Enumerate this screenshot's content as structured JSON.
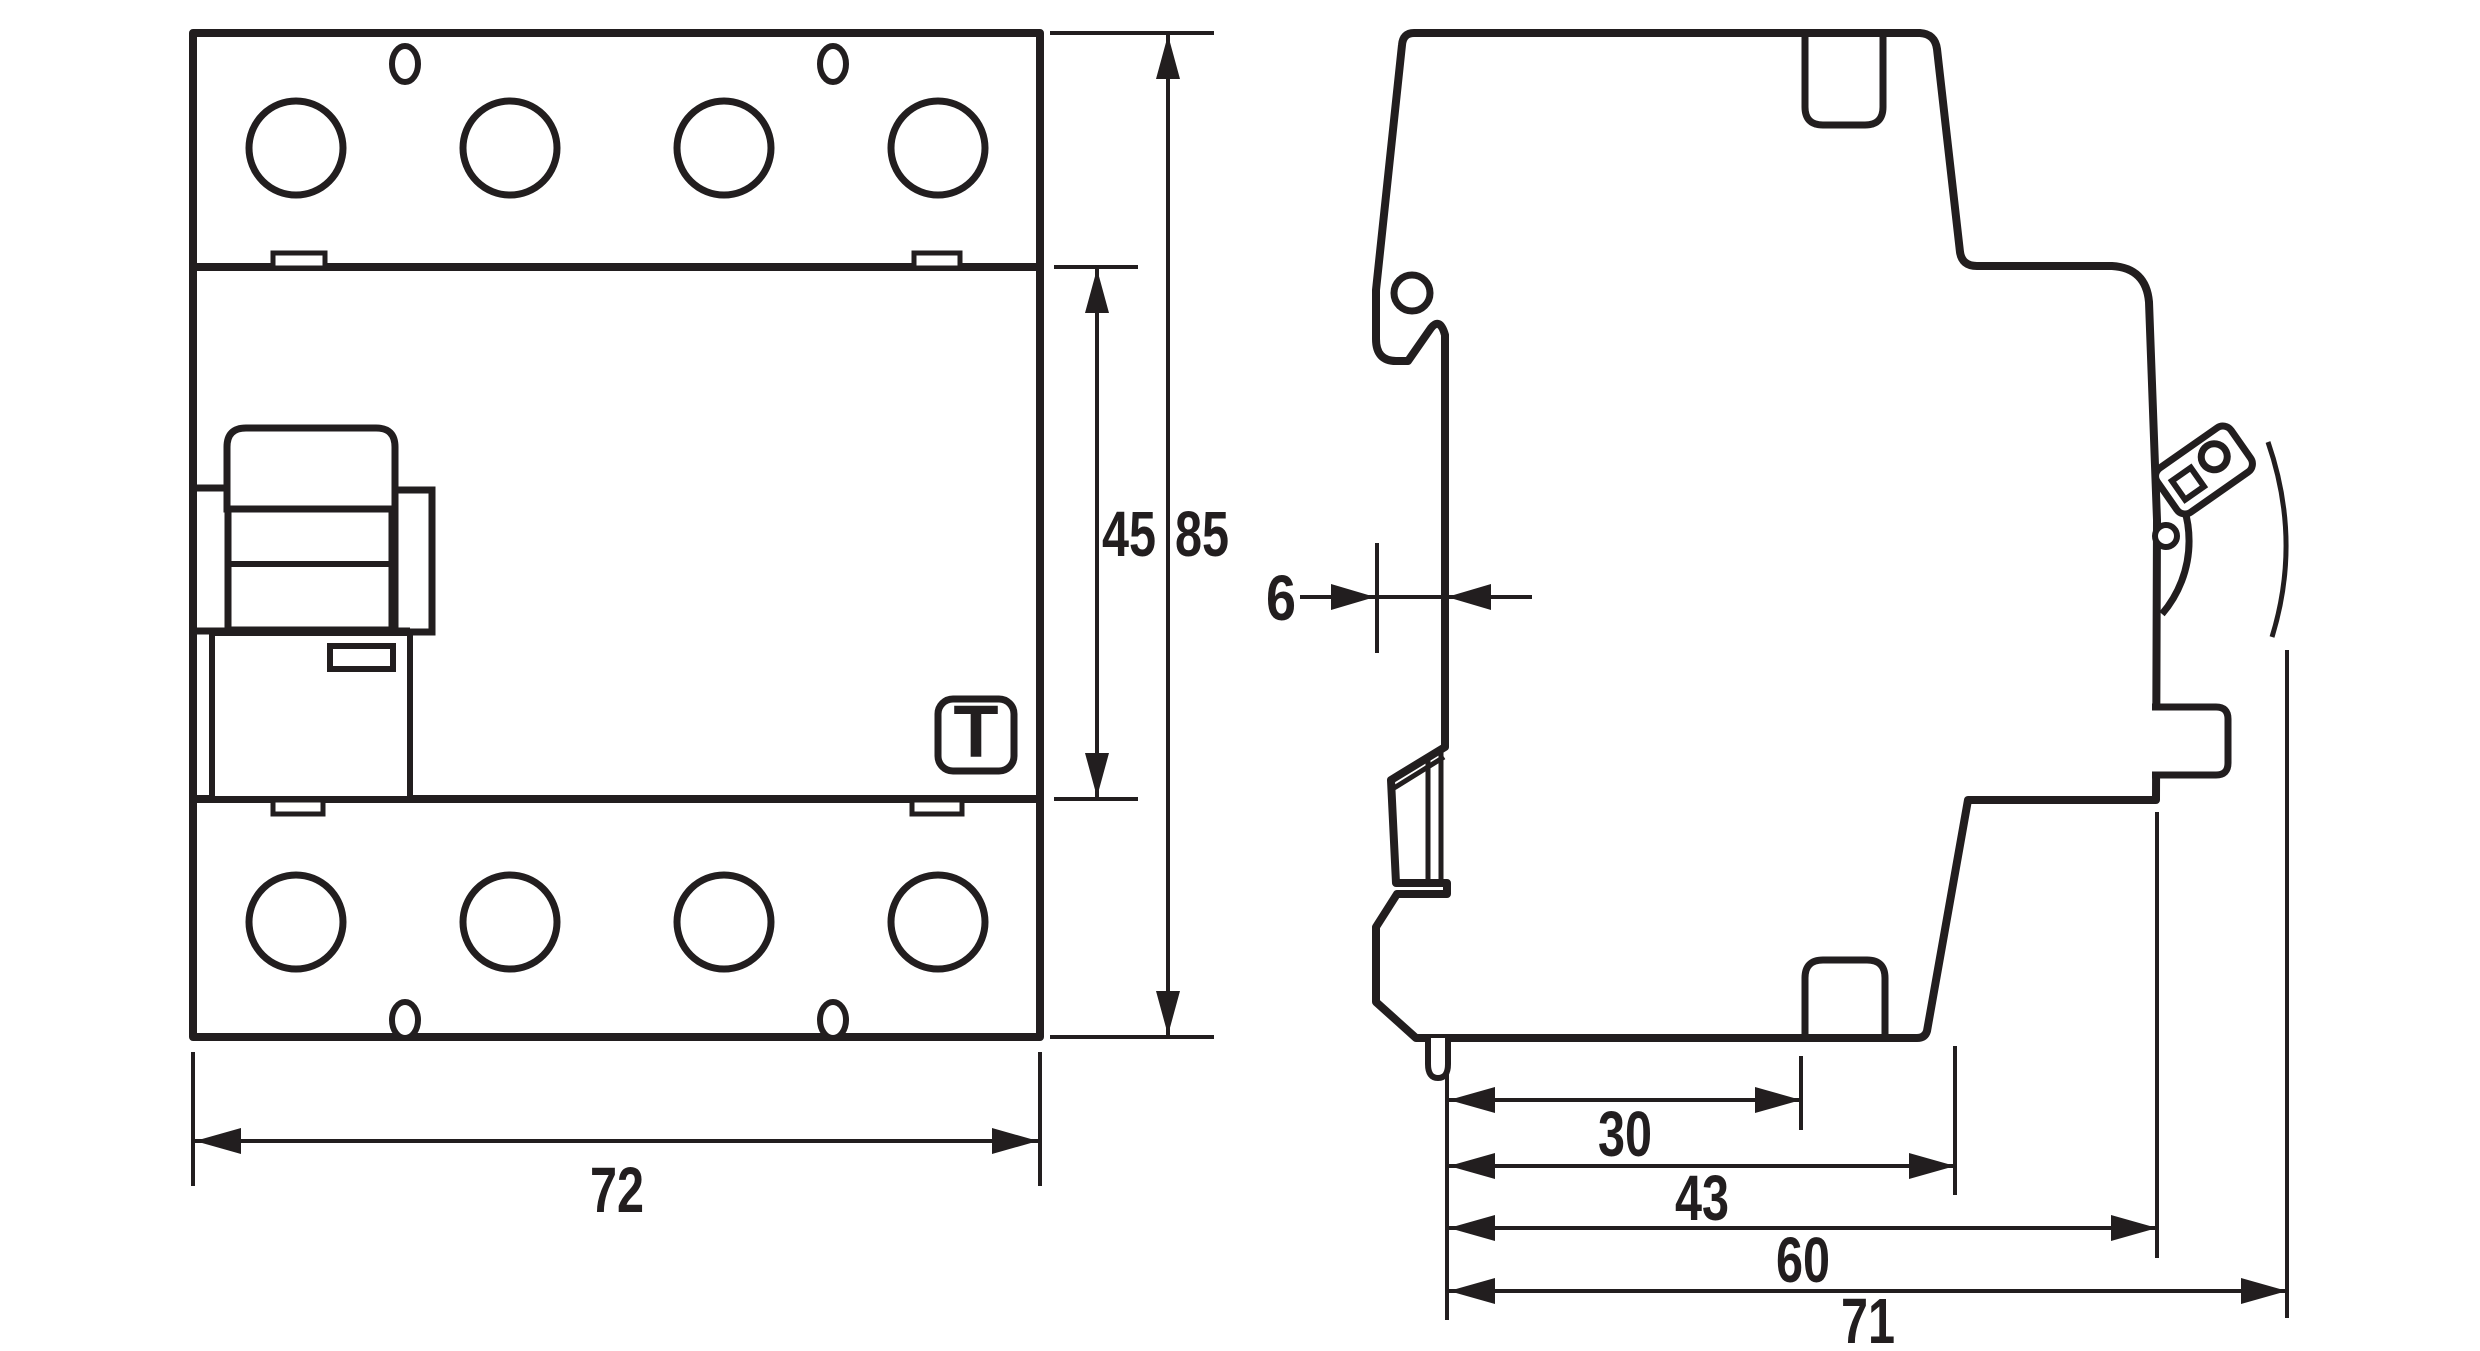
{
  "logo": {
    "letter": "T"
  },
  "dimensions": {
    "front_width_mm": "72",
    "front_upper_height_mm": "45",
    "front_total_height_mm": "85",
    "side_rail_offset_mm": "6",
    "side_depths_mm": [
      "30",
      "43",
      "60",
      "71"
    ]
  },
  "colors": {
    "line": "#221e1f",
    "background": "#ffffff"
  }
}
